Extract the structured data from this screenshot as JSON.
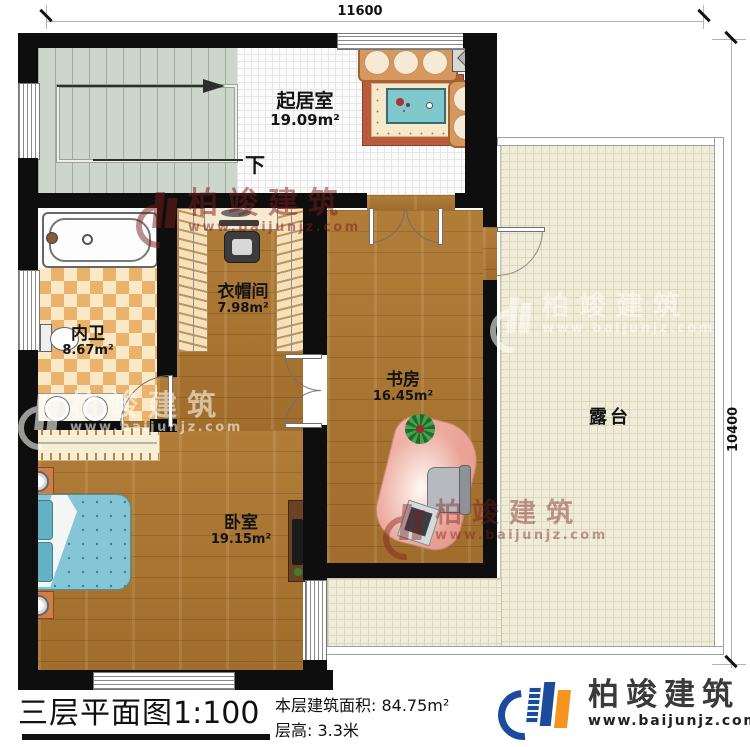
{
  "dimensions": {
    "width_label": "11600",
    "height_label": "10400"
  },
  "rooms": {
    "living": {
      "name": "起居室",
      "area": "19.09m²"
    },
    "cloakroom": {
      "name": "衣帽间",
      "area": "7.98m²"
    },
    "bathroom": {
      "name": "内卫",
      "area": "8.67m²"
    },
    "study": {
      "name": "书房",
      "area": "16.45m²"
    },
    "bedroom": {
      "name": "卧室",
      "area": "19.15m²"
    },
    "terrace": {
      "name": "露台"
    }
  },
  "stairs": {
    "direction_label": "下"
  },
  "title_block": {
    "title": "三层平面图",
    "scale": "1:100",
    "area_line": "本层建筑面积: 84.75m²",
    "height_line": "层高: 3.3米"
  },
  "branding": {
    "company": "柏竣建筑",
    "website": "www.baijunjz.com"
  },
  "watermark": {
    "company": "柏竣建筑",
    "website": "www.baijunjz.com"
  },
  "colors": {
    "brand_blue": "#1c4b9b",
    "brand_orange": "#f7941d",
    "watermark_red": "#7a1d1d",
    "wall_black": "#0e0e0e",
    "wood": "#aa7531",
    "terrace_fill": "#efecda"
  }
}
